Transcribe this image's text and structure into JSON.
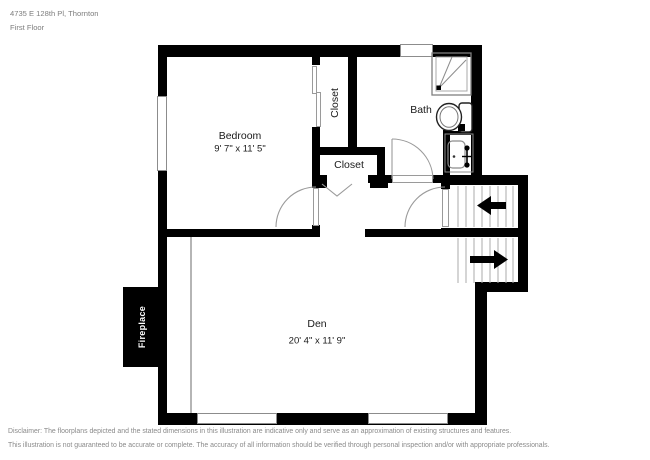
{
  "header": {
    "address": "4735 E 128th Pl, Thornton",
    "floor_label": "First Floor"
  },
  "plan": {
    "bedroom": {
      "label": "Bedroom",
      "dimensions": "9' 7\" x 11' 5\""
    },
    "closet_bedroom": {
      "label": "Closet"
    },
    "closet_hall": {
      "label": "Closet"
    },
    "bath": {
      "label": "Bath"
    },
    "den": {
      "label": "Den",
      "dimensions": "20' 4\" x 11' 9\""
    },
    "fireplace": {
      "label": "Fireplace"
    }
  },
  "colors": {
    "wall": "#000000",
    "room_label": "#1a1a1a",
    "muted_text": "#7d7d7d",
    "fixture_line": "#8c8c8c",
    "step_line": "#aaaaaa"
  },
  "footer": {
    "line1": "Disclaimer: The floorplans depicted and the stated dimensions in this illustration are indicative only and serve as an approximation of existing structures and features.",
    "line2": "This illustration is not guaranteed to be accurate or complete. The accuracy of all information should be verified through personal inspection and/or with appropriate professionals."
  }
}
